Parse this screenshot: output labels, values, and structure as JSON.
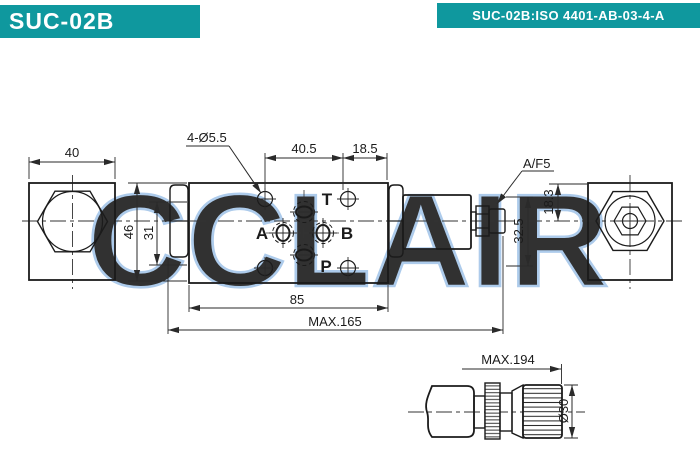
{
  "header": {
    "model": "SUC-02B",
    "spec": "SUC-02B:ISO 4401-AB-03-4-A",
    "banner_color": "#0F989E"
  },
  "watermark": {
    "text": "CCLAIR",
    "color": "#A5C6E9"
  },
  "drawing": {
    "labels": {
      "bolt_holes": "4-Ø5.5",
      "wrench_flats": "A/F5"
    },
    "ports": {
      "top": "T",
      "left": "A",
      "right": "B",
      "bottom": "P"
    },
    "dimensions": {
      "end_block_width": "40",
      "bolt_span": "40.5",
      "edge_offset": "18.5",
      "body_width": "46",
      "inner_span": "31",
      "adjuster_height": "32.5",
      "axis_offset": "18.3",
      "body_length": "85",
      "overall_length": "MAX.165"
    }
  },
  "detail": {
    "dimensions": {
      "overall_length_with_knob": "MAX.194",
      "knob_diameter": "Ø30"
    }
  }
}
